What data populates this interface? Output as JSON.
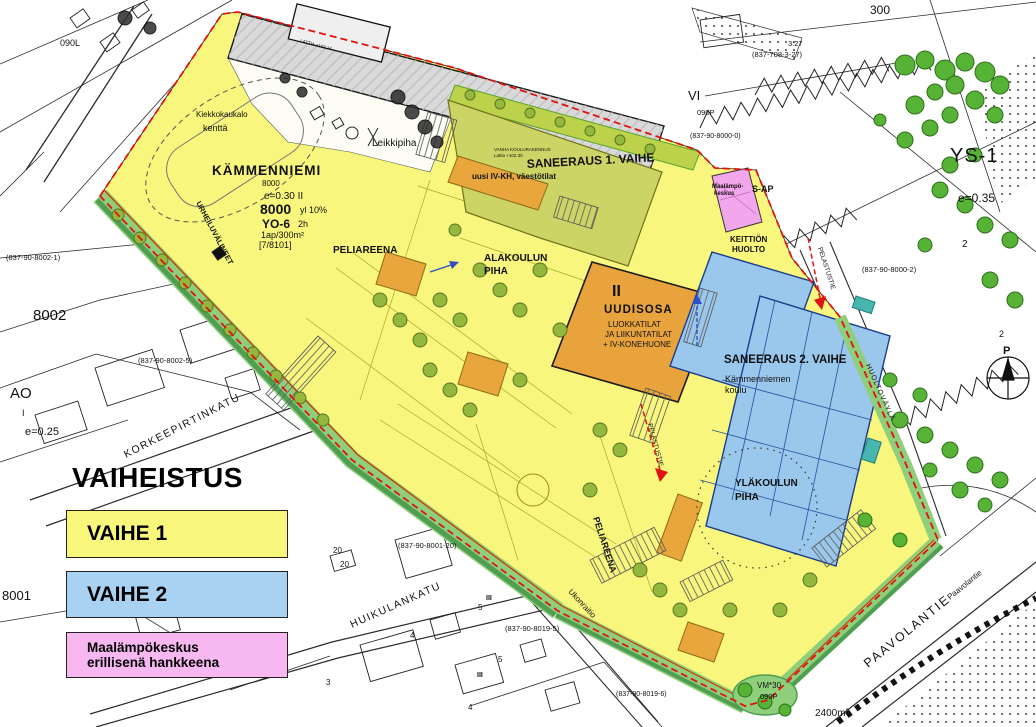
{
  "colors": {
    "phase1_yellow": "#f8f77b",
    "phase2_blue": "#a9d2f2",
    "heat_pink": "#f7b7f0",
    "boundary_red": "#e01212",
    "olive_building": "#ccd465",
    "orange_building": "#e9a63c",
    "grass_green": "#8fce7a",
    "tree_green": "#56b336",
    "orange_label": "#f08a1a"
  },
  "legend": {
    "title": "VAIHEISTUS",
    "phase1": "VAIHE 1",
    "phase2": "VAIHE 2",
    "extra_line1": "Maalämpökeskus",
    "extra_line2": "erillisenä hankkeena"
  },
  "zoning": {
    "name": "KÄMMENNIEMI",
    "area": "8000",
    "efficiency": "e=0.30  II",
    "build_right": "8000",
    "build_right2": "yl 10%",
    "use": "YO-6",
    "use2": "2h",
    "parking": "1ap/300m²",
    "ref": "[7/8101]"
  },
  "phases": {
    "s1": "SANEERAUS 1. VAIHE",
    "s2": "SANEERAUS 2. VAIHE",
    "new_floors": "II",
    "new_name": "UUDISOSA",
    "new_l1": "LUOKKATILAT",
    "new_l2": "JA LIIKUNTATILAT",
    "new_l3": "+ IV-KONEHUONE",
    "old1": "VANHA KOULURAKENNUS",
    "old2": "Lattia +102.30",
    "old3": "LATTIA +103.74",
    "ivkh": "uusi IV-KH, väestötilat",
    "school1": "Kämmenniemen",
    "school2": "koulu",
    "heat1": "Maalämpö-",
    "heat2": "keskus"
  },
  "yards": {
    "kiekko1": "Kiekkokaukalo",
    "kiekko2": "kenttä",
    "urheilu": "URHEILUVÄLINEET",
    "peli": "PELIAREENA",
    "ala1": "ALAKOULUN",
    "ala2": "PIHA",
    "yla1": "YLÄKOULUN",
    "yla2": "PIHA",
    "keittio1": "KEITTIÖN",
    "keittio2": "HUOLTO",
    "leikki": "Leikkipiha",
    "sap": "S-AP",
    "pelastus": "PELASTUSTIE"
  },
  "streets": {
    "korkeepirtinkatu": "KORKEEPIRTINKATU",
    "huikulankatu": "HUIKULANKATU",
    "paavolantie": "PAAVOLANTIE",
    "paavolantie_small": "Paavolantie",
    "huoltovayla": "HUOLTOVÄYLÄ",
    "ukonraitio": "Ukonraitio"
  },
  "parcels": {
    "p8002": "8002",
    "p8001": "8001",
    "ao": "AO",
    "ao_floor": "I",
    "e025": "e=0.25",
    "e035": "e=0.35",
    "ys1": "YS-1",
    "n300": "300",
    "vi": "VI",
    "l090": "090L",
    "p090": "090P",
    "vm30": "VM*30",
    "area2400": "2400m²",
    "north": "P",
    "r1": "(837-90-8002-1)",
    "r2": "(837-90-8002-5)",
    "r3": "(837-90-8001-20)",
    "r4": "(837-90-8019-5)",
    "r5": "(837-90-8019-6)",
    "r6": "(837-90-8000-2)",
    "r7": "(837-708-3-27)",
    "r8": "3:27",
    "r9": "(837-90-8000-0)",
    "n2": "2",
    "n20": "20",
    "n3": "3",
    "n4": "4",
    "n5": "5",
    "niii": "III"
  }
}
